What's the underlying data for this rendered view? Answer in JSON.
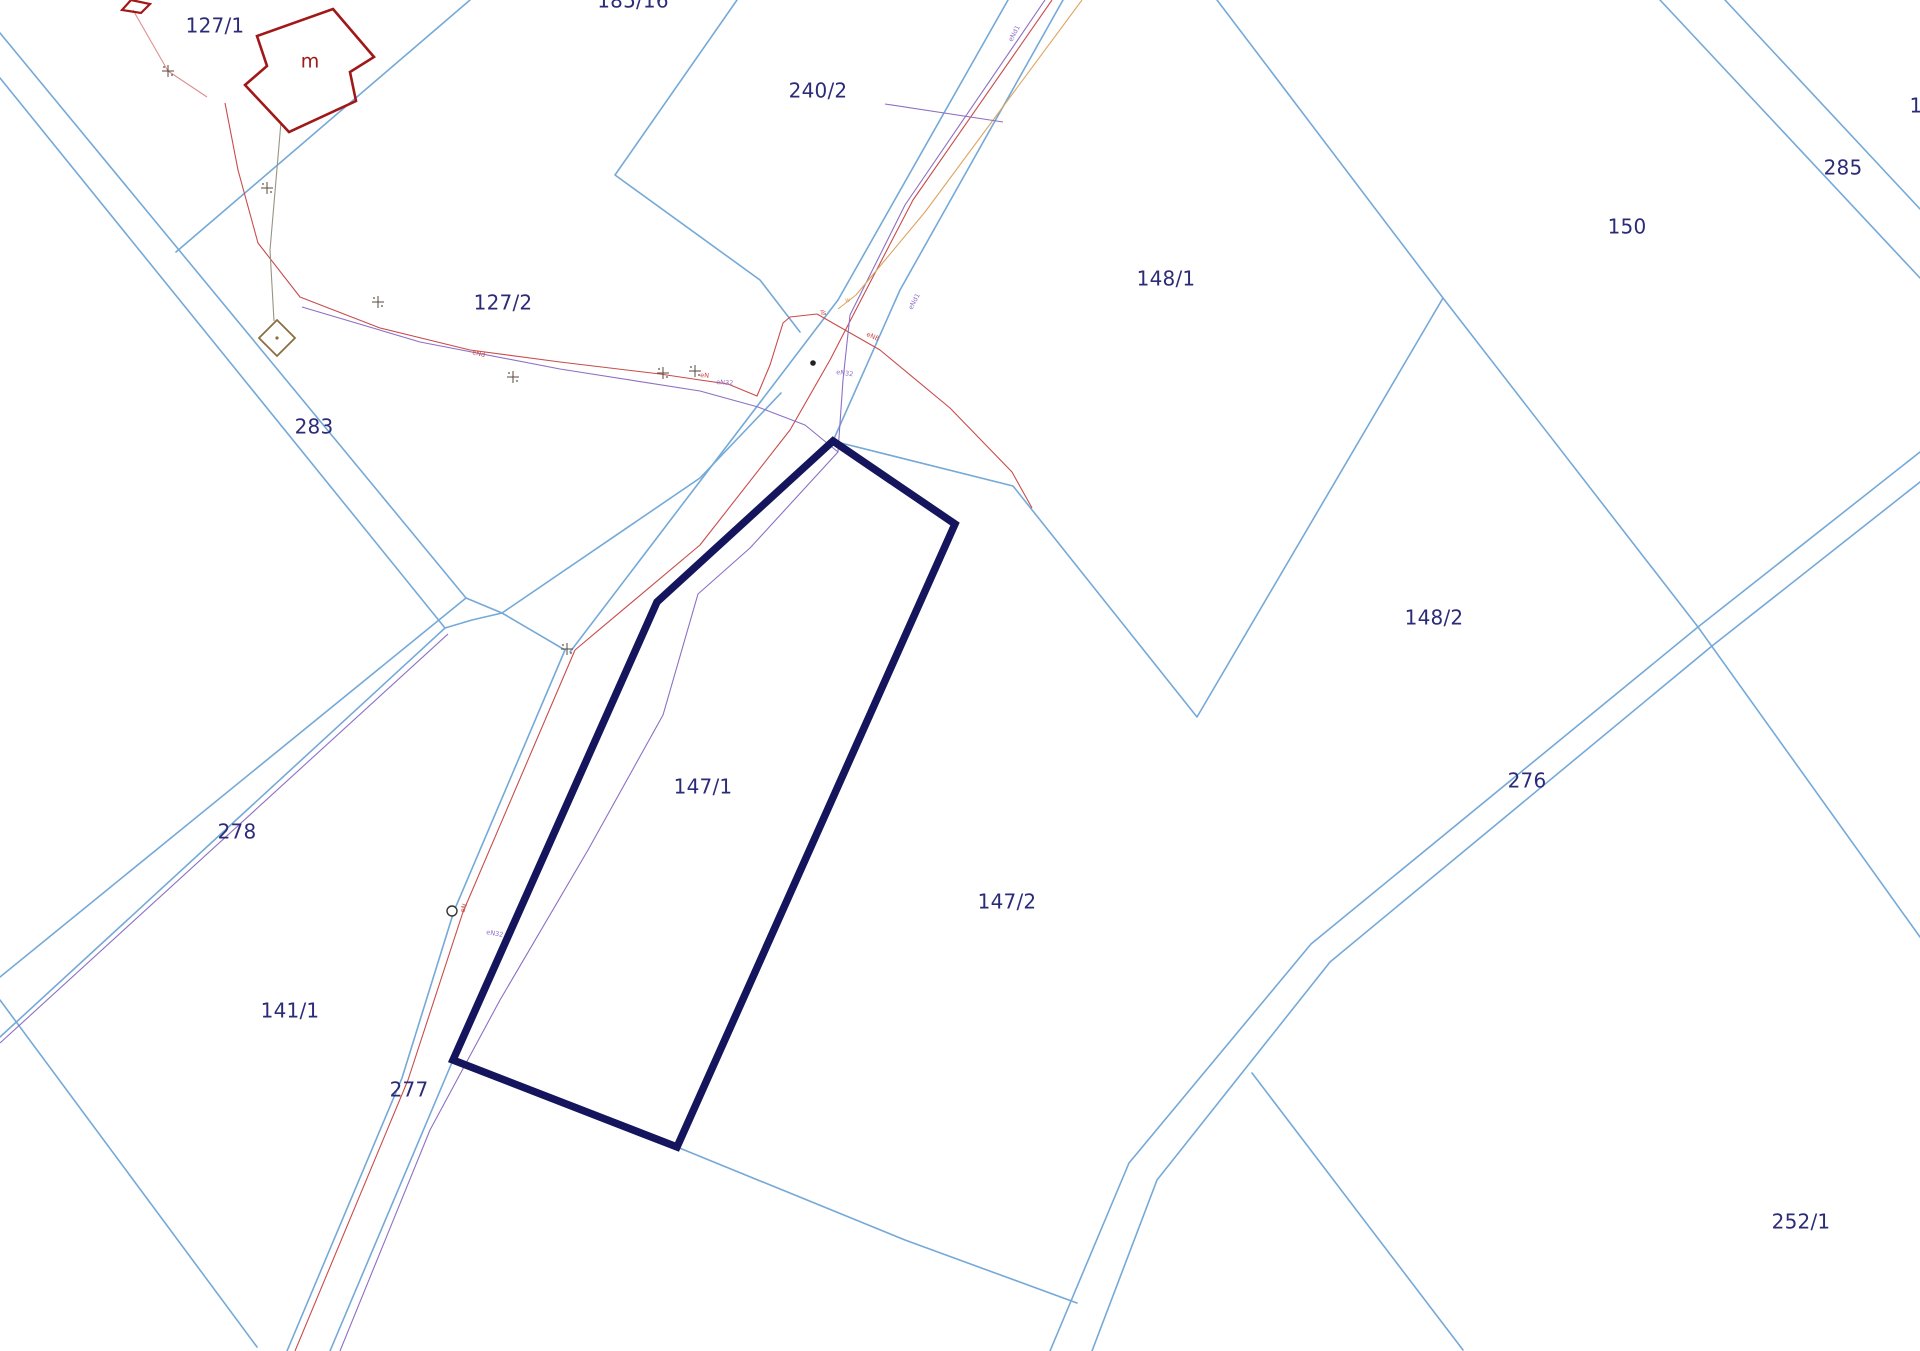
{
  "map": {
    "title": "cadastral-parcel-map",
    "colors": {
      "background": "#ffffff",
      "boundary_blue": "#74a9d8",
      "highlight_navy": "#15155e",
      "label_navy": "#2b2b78",
      "red": "#c94b4b",
      "pink": "#dd8f8f",
      "purple": "#8d6fc4",
      "orange": "#dda45f",
      "building_red": "#a01818",
      "olive": "#8b6f3f",
      "gray": "#9a9384",
      "marker_dark": "#5a4a3a"
    },
    "highlight_parcel": {
      "label": "147/1",
      "points": [
        [
          833,
          441
        ],
        [
          955,
          524
        ],
        [
          677,
          1147
        ],
        [
          453,
          1060
        ],
        [
          657,
          602
        ]
      ]
    },
    "parcel_labels": [
      {
        "text": "127/1",
        "x": 215,
        "y": 27
      },
      {
        "text": "185/16",
        "x": 633,
        "y": 2
      },
      {
        "text": "240/2",
        "x": 818,
        "y": 92
      },
      {
        "text": "148/1",
        "x": 1166,
        "y": 280
      },
      {
        "text": "150",
        "x": 1627,
        "y": 228
      },
      {
        "text": "285",
        "x": 1843,
        "y": 169
      },
      {
        "text": "1",
        "x": 1916,
        "y": 107
      },
      {
        "text": "127/2",
        "x": 503,
        "y": 304
      },
      {
        "text": "283",
        "x": 314,
        "y": 428
      },
      {
        "text": "148/2",
        "x": 1434,
        "y": 619
      },
      {
        "text": "276",
        "x": 1527,
        "y": 782
      },
      {
        "text": "278",
        "x": 237,
        "y": 833
      },
      {
        "text": "147/1",
        "x": 703,
        "y": 788
      },
      {
        "text": "147/2",
        "x": 1007,
        "y": 903
      },
      {
        "text": "141/1",
        "x": 290,
        "y": 1012
      },
      {
        "text": "277",
        "x": 409,
        "y": 1091
      },
      {
        "text": "252/1",
        "x": 1801,
        "y": 1223
      }
    ],
    "building_label": {
      "text": "m",
      "x": 310,
      "y": 62
    },
    "boundary_lines": [
      {
        "name": "road-283-upper",
        "points": [
          [
            0,
            33
          ],
          [
            466,
            598
          ]
        ]
      },
      {
        "name": "road-283-lower",
        "points": [
          [
            0,
            78
          ],
          [
            445,
            628
          ]
        ]
      },
      {
        "name": "junction-link-a",
        "points": [
          [
            466,
            598
          ],
          [
            502,
            613
          ],
          [
            565,
            650
          ]
        ]
      },
      {
        "name": "junction-link-b",
        "points": [
          [
            445,
            628
          ],
          [
            472,
            620
          ],
          [
            502,
            613
          ]
        ]
      },
      {
        "name": "strip-mid-line",
        "points": [
          [
            502,
            613
          ],
          [
            700,
            478
          ],
          [
            781,
            393
          ]
        ]
      },
      {
        "name": "road-278-upper",
        "points": [
          [
            466,
            598
          ],
          [
            0,
            977
          ]
        ]
      },
      {
        "name": "road-278-lower",
        "points": [
          [
            445,
            628
          ],
          [
            0,
            1037
          ]
        ]
      },
      {
        "name": "boundary-sw",
        "points": [
          [
            0,
            1000
          ],
          [
            257,
            1347
          ]
        ]
      },
      {
        "name": "road-277-left",
        "points": [
          [
            565,
            650
          ],
          [
            454,
            911
          ],
          [
            402,
            1078
          ],
          [
            287,
            1351
          ]
        ]
      },
      {
        "name": "road-277-right",
        "points": [
          [
            453,
            1060
          ],
          [
            330,
            1351
          ]
        ]
      },
      {
        "name": "boundary-127-1-185-16",
        "points": [
          [
            470,
            0
          ],
          [
            176,
            252
          ]
        ]
      },
      {
        "name": "boundary-240-2-west",
        "points": [
          [
            737,
            0
          ],
          [
            615,
            175
          ],
          [
            760,
            280
          ],
          [
            800,
            332
          ]
        ]
      },
      {
        "name": "road-ne-left",
        "points": [
          [
            1008,
            0
          ],
          [
            838,
            300
          ],
          [
            570,
            652
          ]
        ]
      },
      {
        "name": "road-ne-right",
        "points": [
          [
            1063,
            0
          ],
          [
            900,
            290
          ],
          [
            833,
            441
          ]
        ]
      },
      {
        "name": "boundary-148-1-147-2",
        "points": [
          [
            833,
            441
          ],
          [
            1013,
            486
          ],
          [
            1197,
            717
          ],
          [
            1443,
            298
          ]
        ]
      },
      {
        "name": "boundary-240-2-148-1",
        "points": [
          [
            1217,
            0
          ],
          [
            1443,
            298
          ]
        ]
      },
      {
        "name": "boundary-150-south",
        "points": [
          [
            1443,
            298
          ],
          [
            1698,
            627
          ],
          [
            1920,
            937
          ]
        ]
      },
      {
        "name": "road-285-upper",
        "points": [
          [
            1660,
            0
          ],
          [
            1920,
            278
          ]
        ]
      },
      {
        "name": "road-285-lower",
        "points": [
          [
            1725,
            0
          ],
          [
            1920,
            209
          ]
        ]
      },
      {
        "name": "road-276-ne-upper",
        "points": [
          [
            1698,
            627
          ],
          [
            1920,
            452
          ]
        ]
      },
      {
        "name": "road-276-ne-lower",
        "points": [
          [
            1712,
            646
          ],
          [
            1920,
            482
          ]
        ]
      },
      {
        "name": "road-276-sw-nw",
        "points": [
          [
            1698,
            627
          ],
          [
            1311,
            944
          ],
          [
            1129,
            1163
          ],
          [
            1050,
            1351
          ]
        ]
      },
      {
        "name": "road-276-sw-se",
        "points": [
          [
            1712,
            646
          ],
          [
            1330,
            962
          ],
          [
            1157,
            1180
          ],
          [
            1092,
            1351
          ]
        ]
      },
      {
        "name": "branch-252-1",
        "points": [
          [
            1252,
            1073
          ],
          [
            1463,
            1350
          ]
        ]
      },
      {
        "name": "boundary-147-2-south",
        "points": [
          [
            677,
            1147
          ],
          [
            905,
            1240
          ],
          [
            1077,
            1303
          ]
        ]
      }
    ],
    "utility_lines": [
      {
        "name": "power-arc-red",
        "color": "red",
        "points": [
          [
            225,
            103
          ],
          [
            238,
            170
          ],
          [
            258,
            243
          ],
          [
            300,
            297
          ],
          [
            380,
            328
          ],
          [
            470,
            350
          ],
          [
            560,
            362
          ],
          [
            660,
            374
          ],
          [
            700,
            380
          ],
          [
            728,
            384
          ],
          [
            757,
            396
          ],
          [
            770,
            365
          ],
          [
            783,
            323
          ],
          [
            790,
            317
          ],
          [
            817,
            314
          ]
        ]
      },
      {
        "name": "power-road-red",
        "color": "red",
        "points": [
          [
            1052,
            0
          ],
          [
            913,
            200
          ],
          [
            862,
            298
          ],
          [
            830,
            360
          ],
          [
            790,
            430
          ],
          [
            700,
            545
          ],
          [
            575,
            650
          ]
        ]
      },
      {
        "name": "power-277-red",
        "color": "red",
        "points": [
          [
            575,
            650
          ],
          [
            463,
            912
          ],
          [
            408,
            1080
          ],
          [
            295,
            1351
          ]
        ]
      },
      {
        "name": "power-branch-se-red",
        "color": "red",
        "points": [
          [
            817,
            314
          ],
          [
            880,
            350
          ],
          [
            950,
            408
          ],
          [
            1012,
            472
          ],
          [
            1032,
            508
          ]
        ]
      },
      {
        "name": "power-nw-pink",
        "color": "pink",
        "points": [
          [
            133,
            10
          ],
          [
            168,
            71
          ],
          [
            207,
            97
          ]
        ]
      },
      {
        "name": "telecom-arc-purple",
        "color": "purple",
        "points": [
          [
            302,
            307
          ],
          [
            420,
            342
          ],
          [
            560,
            369
          ],
          [
            700,
            391
          ],
          [
            758,
            407
          ],
          [
            805,
            425
          ],
          [
            838,
            452
          ],
          [
            750,
            548
          ],
          [
            698,
            594
          ],
          [
            663,
            715
          ],
          [
            588,
            850
          ],
          [
            500,
            1000
          ],
          [
            430,
            1130
          ],
          [
            340,
            1351
          ]
        ]
      },
      {
        "name": "telecom-road-purple",
        "color": "purple",
        "points": [
          [
            1045,
            0
          ],
          [
            905,
            205
          ],
          [
            850,
            315
          ],
          [
            843,
            380
          ],
          [
            838,
            452
          ]
        ]
      },
      {
        "name": "telecom-278-purple",
        "color": "purple",
        "points": [
          [
            448,
            634
          ],
          [
            0,
            1043
          ]
        ]
      },
      {
        "name": "gas-road-orange",
        "color": "orange",
        "points": [
          [
            1082,
            0
          ],
          [
            925,
            212
          ],
          [
            856,
            295
          ],
          [
            838,
            309
          ]
        ]
      },
      {
        "name": "service-gray",
        "color": "gray",
        "points": [
          [
            281,
            122
          ],
          [
            270,
            250
          ],
          [
            274,
            321
          ]
        ]
      },
      {
        "name": "telecom-240-purple",
        "color": "purple",
        "points": [
          [
            885,
            104
          ],
          [
            1003,
            122
          ]
        ]
      }
    ],
    "utility_labels": [
      {
        "text": "eNd1",
        "x": 912,
        "y": 310,
        "rot": -62,
        "color": "purple"
      },
      {
        "text": "eNd1",
        "x": 1012,
        "y": 42,
        "rot": -62,
        "color": "purple"
      },
      {
        "text": "eN32",
        "x": 836,
        "y": 374,
        "rot": 8,
        "color": "purple"
      },
      {
        "text": "eN32",
        "x": 716,
        "y": 384,
        "rot": 4,
        "color": "purple"
      },
      {
        "text": "eNd",
        "x": 472,
        "y": 354,
        "rot": 14,
        "color": "red"
      },
      {
        "text": "eN8",
        "x": 866,
        "y": 336,
        "rot": 22,
        "color": "red"
      },
      {
        "text": "Ts",
        "x": 820,
        "y": 315,
        "rot": 0,
        "color": "red"
      },
      {
        "text": "eN",
        "x": 700,
        "y": 377,
        "rot": 5,
        "color": "red"
      },
      {
        "text": "eN",
        "x": 464,
        "y": 913,
        "rot": -70,
        "color": "red"
      },
      {
        "text": "eN32",
        "x": 486,
        "y": 934,
        "rot": 10,
        "color": "purple"
      },
      {
        "text": "w",
        "x": 845,
        "y": 302,
        "rot": 0,
        "color": "orange"
      }
    ],
    "buildings": [
      {
        "name": "building-m",
        "type": "polygon",
        "color": "building_red",
        "width": 2.6,
        "points": [
          [
            333,
            9
          ],
          [
            374,
            57
          ],
          [
            350,
            72
          ],
          [
            356,
            101
          ],
          [
            289,
            132
          ],
          [
            245,
            85
          ],
          [
            267,
            66
          ],
          [
            257,
            36
          ]
        ]
      },
      {
        "name": "building-corner-partial",
        "type": "polygon",
        "color": "building_red",
        "width": 2.2,
        "points": [
          [
            122,
            10
          ],
          [
            131,
            0
          ],
          [
            150,
            4
          ],
          [
            141,
            13
          ]
        ]
      },
      {
        "name": "building-diamond",
        "type": "polygon",
        "color": "olive",
        "width": 1.8,
        "points": [
          [
            277,
            320
          ],
          [
            295,
            338
          ],
          [
            277,
            356
          ],
          [
            259,
            338
          ]
        ]
      }
    ],
    "markers": {
      "crosses": [
        [
          168,
          71
        ],
        [
          267,
          188
        ],
        [
          378,
          302
        ],
        [
          513,
          377
        ],
        [
          663,
          373
        ],
        [
          695,
          371
        ],
        [
          567,
          649
        ]
      ],
      "dot": [
        813,
        363
      ],
      "circle": [
        452,
        911
      ],
      "diamond_dot": [
        277,
        338
      ]
    }
  }
}
